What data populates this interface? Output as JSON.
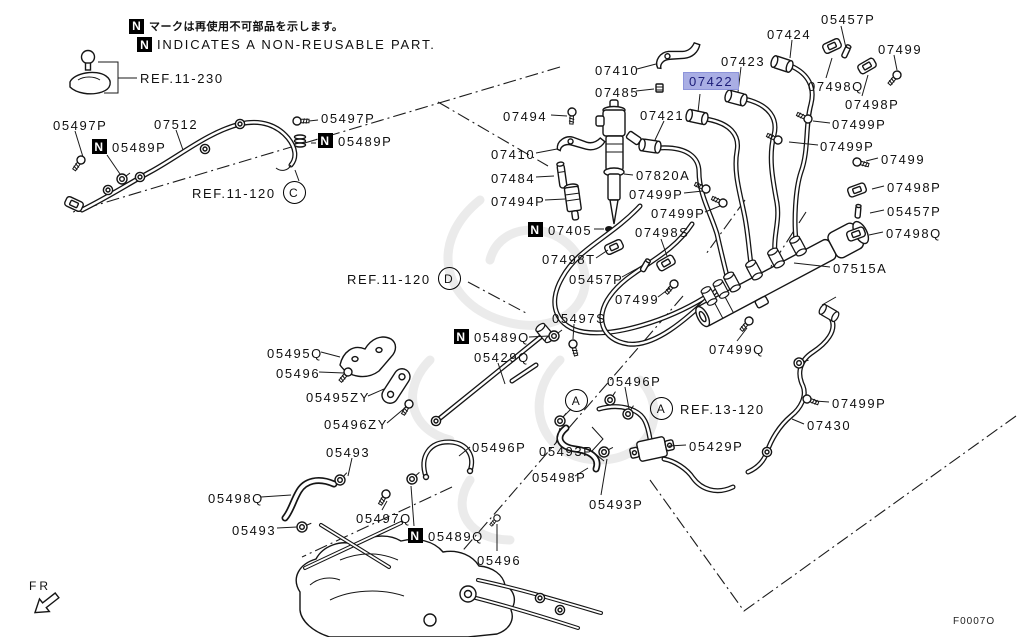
{
  "selected_part": "07422",
  "highlight": {
    "bg": "#a9aee4",
    "fg": "#1c1c78",
    "border": "#8d94da"
  },
  "notes": {
    "jp": "マークは再使用不可部品を示します。",
    "en": "INDICATES A NON-REUSABLE PART."
  },
  "fr_label": "FR",
  "diagram_code": "F0007O",
  "labels": [
    {
      "t": "REF.11-230",
      "x": 140,
      "y": 71,
      "k": "ref"
    },
    {
      "t": "05497P",
      "x": 53,
      "y": 118
    },
    {
      "t": "07512",
      "x": 154,
      "y": 117
    },
    {
      "t": "05489P",
      "x": 92,
      "y": 139,
      "n": 1
    },
    {
      "t": "05497P",
      "x": 321,
      "y": 111
    },
    {
      "t": "05489P",
      "x": 318,
      "y": 133,
      "n": 1
    },
    {
      "t": "REF.11-120",
      "x": 192,
      "y": 181,
      "k": "ref",
      "ca": "C"
    },
    {
      "t": "07410",
      "x": 595,
      "y": 63
    },
    {
      "t": "07485",
      "x": 595,
      "y": 85
    },
    {
      "t": "07422",
      "x": 688,
      "y": 74,
      "hl": 1
    },
    {
      "t": "07423",
      "x": 721,
      "y": 54
    },
    {
      "t": "07424",
      "x": 767,
      "y": 27
    },
    {
      "t": "05457P",
      "x": 821,
      "y": 12
    },
    {
      "t": "07499",
      "x": 878,
      "y": 42
    },
    {
      "t": "07498Q",
      "x": 808,
      "y": 79
    },
    {
      "t": "07498P",
      "x": 845,
      "y": 97
    },
    {
      "t": "07499P",
      "x": 832,
      "y": 117
    },
    {
      "t": "07499P",
      "x": 820,
      "y": 139
    },
    {
      "t": "07494",
      "x": 503,
      "y": 109
    },
    {
      "t": "07421",
      "x": 640,
      "y": 108
    },
    {
      "t": "07410",
      "x": 491,
      "y": 147
    },
    {
      "t": "07484",
      "x": 491,
      "y": 171
    },
    {
      "t": "07494P",
      "x": 491,
      "y": 194
    },
    {
      "t": "07820A",
      "x": 636,
      "y": 168
    },
    {
      "t": "07499P",
      "x": 629,
      "y": 187
    },
    {
      "t": "07499P",
      "x": 651,
      "y": 206
    },
    {
      "t": "07405",
      "x": 528,
      "y": 222,
      "n": 1
    },
    {
      "t": "07498S",
      "x": 635,
      "y": 225
    },
    {
      "t": "07498T",
      "x": 542,
      "y": 252
    },
    {
      "t": "05457P",
      "x": 569,
      "y": 272
    },
    {
      "t": "07499",
      "x": 615,
      "y": 292
    },
    {
      "t": "07499",
      "x": 881,
      "y": 152
    },
    {
      "t": "07498P",
      "x": 887,
      "y": 180
    },
    {
      "t": "05457P",
      "x": 887,
      "y": 204
    },
    {
      "t": "07498Q",
      "x": 886,
      "y": 226
    },
    {
      "t": "07515A",
      "x": 833,
      "y": 261
    },
    {
      "t": "07499Q",
      "x": 709,
      "y": 342
    },
    {
      "t": "REF.11-120",
      "x": 347,
      "y": 267,
      "k": "ref",
      "ca": "D"
    },
    {
      "t": "05497S",
      "x": 552,
      "y": 311
    },
    {
      "t": "05489Q",
      "x": 454,
      "y": 329,
      "n": 1
    },
    {
      "t": "05429Q",
      "x": 474,
      "y": 350
    },
    {
      "t": "05495Q",
      "x": 267,
      "y": 346
    },
    {
      "t": "05496",
      "x": 276,
      "y": 366
    },
    {
      "t": "05495ZY",
      "x": 306,
      "y": 390
    },
    {
      "t": "05496ZY",
      "x": 324,
      "y": 417
    },
    {
      "t": "05493",
      "x": 326,
      "y": 445
    },
    {
      "t": "05496P",
      "x": 607,
      "y": 374
    },
    {
      "t": "",
      "x": 565,
      "y": 389,
      "k": "marker",
      "cb": "A"
    },
    {
      "t": "REF.13-120",
      "x": 650,
      "y": 397,
      "k": "ref",
      "cb": "A"
    },
    {
      "t": "05429P",
      "x": 689,
      "y": 439
    },
    {
      "t": "05493P",
      "x": 539,
      "y": 444
    },
    {
      "t": "05498P",
      "x": 532,
      "y": 470
    },
    {
      "t": "05493P",
      "x": 589,
      "y": 497
    },
    {
      "t": "05496P",
      "x": 472,
      "y": 440
    },
    {
      "t": "07499P",
      "x": 832,
      "y": 396
    },
    {
      "t": "07430",
      "x": 807,
      "y": 418
    },
    {
      "t": "05498Q",
      "x": 208,
      "y": 491
    },
    {
      "t": "05493",
      "x": 232,
      "y": 523
    },
    {
      "t": "05497Q",
      "x": 356,
      "y": 511
    },
    {
      "t": "05489Q",
      "x": 408,
      "y": 528,
      "n": 1
    },
    {
      "t": "05496",
      "x": 477,
      "y": 553
    }
  ]
}
